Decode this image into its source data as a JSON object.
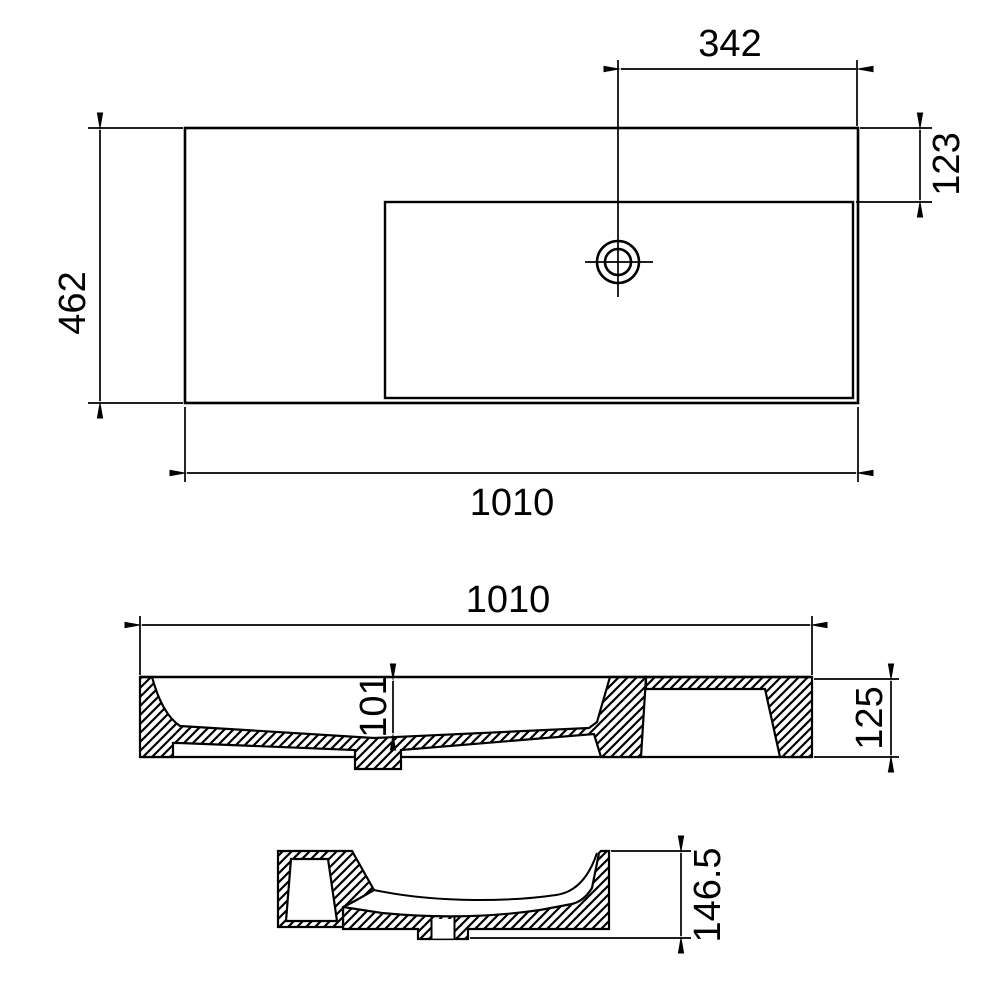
{
  "drawing": {
    "title": "washbasin-three-view-dimension-drawing",
    "line_color": "#000000",
    "background_color": "#ffffff",
    "views": {
      "plan": {
        "dim_drain_to_edge": "342",
        "dim_deck_depth": "123",
        "dim_total_depth": "462",
        "dim_total_width": "1010"
      },
      "front_section": {
        "dim_total_width": "1010",
        "dim_bowl_depth": "101",
        "dim_body_height": "125"
      },
      "side_section": {
        "dim_total_height": "146.5"
      }
    }
  }
}
